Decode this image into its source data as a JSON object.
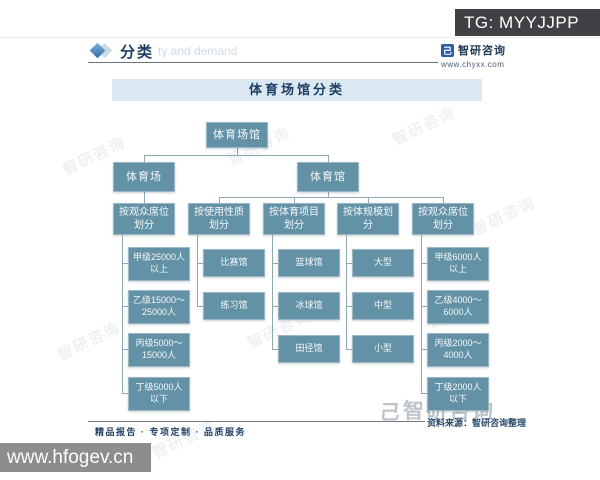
{
  "overlay": {
    "tg_label": "TG: MYYJJPP",
    "url_watermark": "www.hfogev.cn"
  },
  "header": {
    "section_title": "分类",
    "ghost_text": "ty and demand",
    "logo": {
      "name": "智研咨询",
      "site": "www.chyxx.com",
      "mark_glyph": "己"
    }
  },
  "diagram": {
    "title": "体育场馆分类",
    "root": "体育场馆",
    "branches": [
      {
        "label": "体育场"
      },
      {
        "label": "体育馆"
      }
    ],
    "groups": [
      {
        "branch": 0,
        "label": "按观众席位划分",
        "leaves": [
          "甲级25000人以上",
          "乙级15000～25000人",
          "丙级5000～15000人",
          "丁级5000人以下"
        ]
      },
      {
        "branch": 1,
        "label": "按使用性质划分",
        "leaves": [
          "比赛馆",
          "练习馆"
        ]
      },
      {
        "branch": 1,
        "label": "按体育项目划分",
        "leaves": [
          "篮球馆",
          "冰球馆",
          "田径馆"
        ]
      },
      {
        "branch": 1,
        "label": "按体规模划分",
        "leaves": [
          "大型",
          "中型",
          "小型"
        ]
      },
      {
        "branch": 1,
        "label": "按观众席位划分",
        "leaves": [
          "甲级6000人以上",
          "乙级4000～6000人",
          "丙级2000～4000人",
          "丁级2000人以下"
        ]
      }
    ]
  },
  "watermark": {
    "text": "智研咨询"
  },
  "footer": {
    "tagline": "精品报告 · 专项定制 · 品质服务",
    "source": "资料来源：智研咨询整理",
    "brand_watermark": "智研咨询",
    "brand_glyph": "己"
  },
  "colors": {
    "node_fill": "#6391a6",
    "node_border": "#9cb6c3",
    "line_color": "#8ea9b4",
    "band_bg": "#dce8f1",
    "navy": "#1d3f66"
  }
}
